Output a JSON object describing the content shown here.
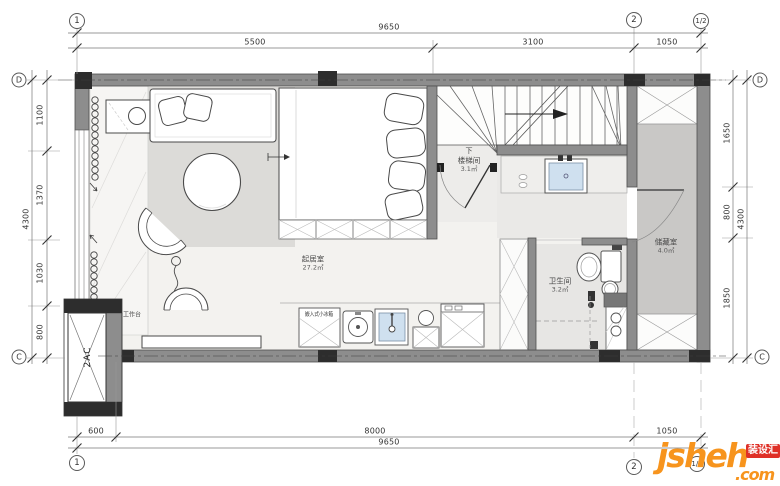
{
  "grid": {
    "col_1": "1",
    "col_2": "2",
    "col_half": "1/2",
    "row_d": "D",
    "row_c": "C"
  },
  "dims": {
    "top_total": "9650",
    "top_segs": [
      "5500",
      "3100",
      "1050"
    ],
    "bottom_segs": [
      "600",
      "8000",
      "1050"
    ],
    "bottom_total": "9650",
    "left_segs": [
      "1100",
      "1370",
      "1030",
      "800"
    ],
    "left_total": "4300",
    "right_segs": [
      "1650",
      "800",
      "1850"
    ],
    "right_total": "4300"
  },
  "rooms": {
    "living": {
      "name": "起居室",
      "area": "27.2㎡"
    },
    "stairwell": {
      "name": "楼梯间",
      "area": "3.1㎡",
      "down": "下"
    },
    "bathroom": {
      "name": "卫生间",
      "area": "3.2㎡"
    },
    "storage": {
      "name": "储藏室",
      "area": "4.0㎡"
    }
  },
  "labels": {
    "worktop": "工作台",
    "mini_fridge": "嵌入式小冰箱",
    "ac_duct": "2AC"
  },
  "watermark": {
    "brand": "jsheh",
    "tld": ".com",
    "badge": "装设汇"
  },
  "colors": {
    "wall": "#8d8d8d",
    "column": "#2d2d2d",
    "floor_living": "#f3f2ef",
    "rug": "#dcdbd8",
    "floor_gray": "#e8e7e5",
    "floor_storage": "#c9c8c6",
    "sink_blue": "#cfe0ef",
    "watermark_orange": "#f7941d",
    "watermark_red": "#df3027"
  }
}
